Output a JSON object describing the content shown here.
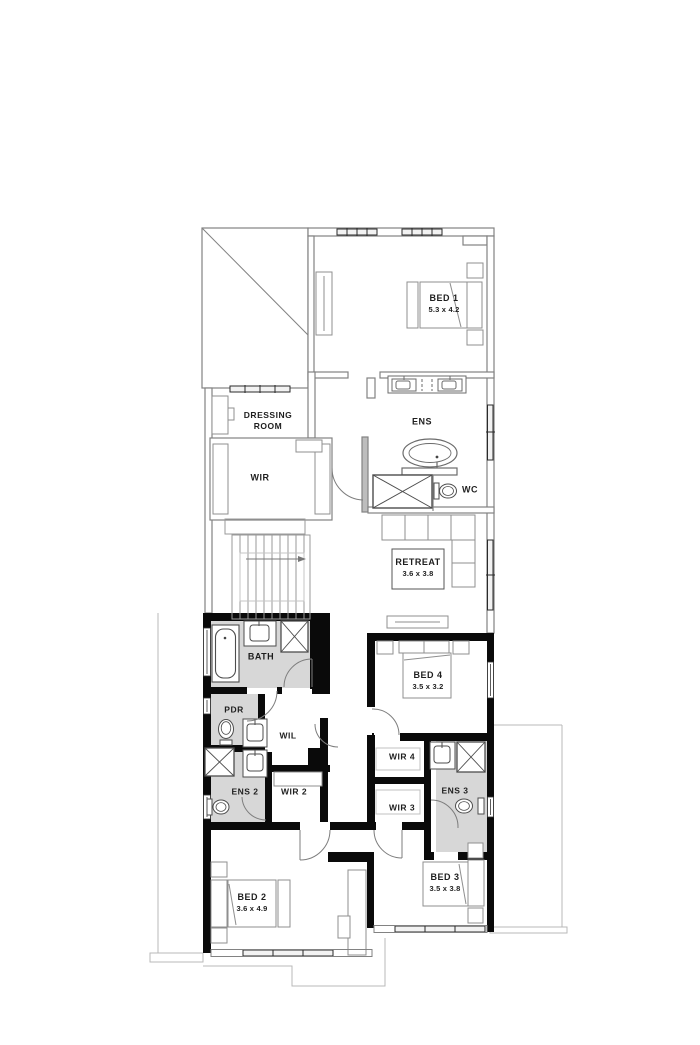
{
  "plan": {
    "type": "residential floor plan - upper level",
    "colors": {
      "wall": "#000000",
      "wet_area_floor": "#d7d7d7",
      "thin_line": "#8a8a8a",
      "text": "#1e1e1e",
      "background": "#ffffff"
    },
    "rooms": {
      "bed1": {
        "label": "BED 1",
        "dims": "5.3 x 4.2"
      },
      "dressing": {
        "label_line1": "DRESSING",
        "label_line2": "ROOM"
      },
      "wir": {
        "label": "WIR"
      },
      "ens": {
        "label": "ENS"
      },
      "wc": {
        "label": "WC"
      },
      "retreat": {
        "label": "RETREAT",
        "dims": "3.6 x 3.8"
      },
      "bath": {
        "label": "BATH"
      },
      "pdr": {
        "label": "PDR"
      },
      "wil": {
        "label": "WIL"
      },
      "ens2": {
        "label": "ENS 2"
      },
      "wir2": {
        "label": "WIR 2"
      },
      "bed4": {
        "label": "BED 4",
        "dims": "3.5 x 3.2"
      },
      "wir4": {
        "label": "WIR 4"
      },
      "wir3": {
        "label": "WIR 3"
      },
      "ens3": {
        "label": "ENS 3"
      },
      "bed2": {
        "label": "BED 2",
        "dims": "3.6 x 4.9"
      },
      "bed3": {
        "label": "BED 3",
        "dims": "3.5 x 3.8"
      }
    },
    "fixtures": [
      "bathtub",
      "freestanding-bath",
      "shower",
      "vanity-basin",
      "double-vanity",
      "toilet",
      "bed",
      "sofa",
      "stairs",
      "desk",
      "wardrobe-shelving",
      "console-table"
    ]
  }
}
